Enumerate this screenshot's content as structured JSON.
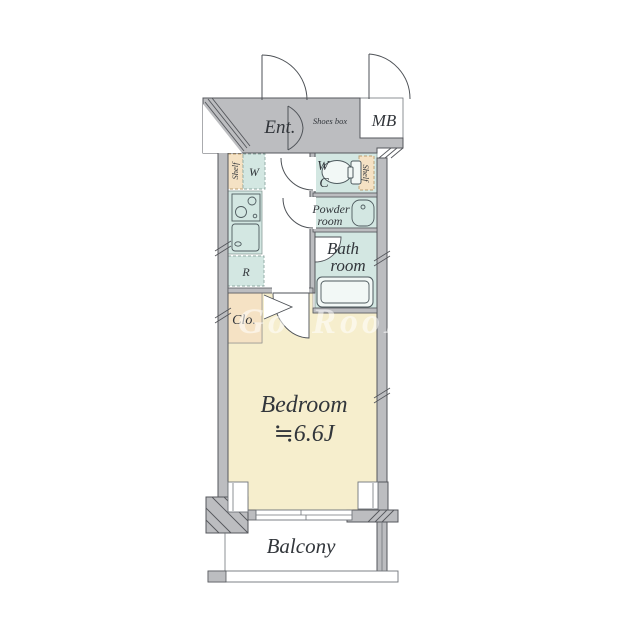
{
  "floorplan": {
    "labels": {
      "entrance": "Ent.",
      "shoes_box": "Shoes box",
      "meter_box": "MB",
      "shelf_left": "Shelf",
      "shelf_right": "Shelf",
      "washer": "W",
      "wc_line1": "W",
      "wc_line2": "C",
      "powder_line1": "Powder",
      "powder_line2": "room",
      "bath_line1": "Bath",
      "bath_line2": "room",
      "fridge": "R",
      "closet": "Clo.",
      "bedroom_line1": "Bedroom",
      "bedroom_line2": "≒6.6J",
      "balcony": "Balcony"
    },
    "watermark": "GooRooM",
    "colors": {
      "wall": "#bcbdc0",
      "wall_outline": "#55575c",
      "wet": "#d3e7e2",
      "tan": "#f5e2c4",
      "bedroom_floor": "#f6eecd",
      "text": "#32363b",
      "dash_wet": "#8fa8a2",
      "dash_tan": "#bb9f72",
      "fixture": "#4e5a5e",
      "watermark_color": "rgba(255,255,255,0.55)"
    }
  }
}
